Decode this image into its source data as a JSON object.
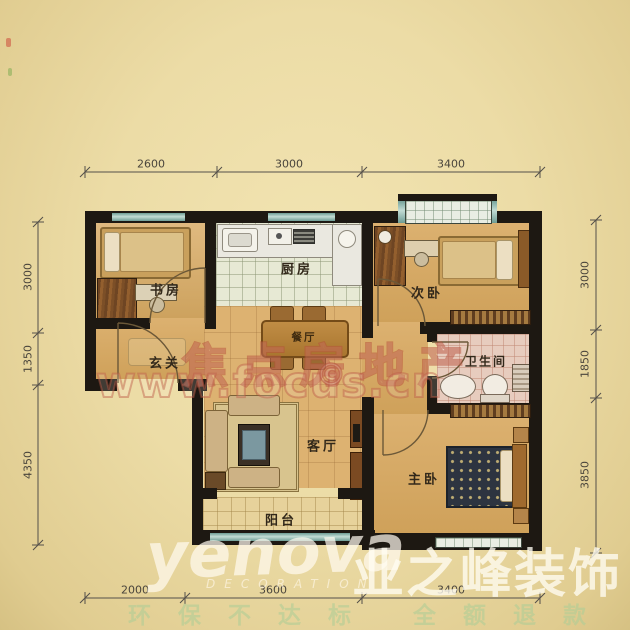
{
  "plan": {
    "rooms": [
      {
        "id": "study",
        "label": "书房"
      },
      {
        "id": "kitchen",
        "label": "厨房"
      },
      {
        "id": "bedroom2",
        "label": "次卧"
      },
      {
        "id": "entry",
        "label": "玄关"
      },
      {
        "id": "dining",
        "label": "餐厅"
      },
      {
        "id": "bathroom",
        "label": "卫生间"
      },
      {
        "id": "living",
        "label": "客厅"
      },
      {
        "id": "master",
        "label": "主卧"
      },
      {
        "id": "balcony",
        "label": "阳台"
      }
    ],
    "dimensions": {
      "top": [
        "2600",
        "3000",
        "3400"
      ],
      "bottom": [
        "2000",
        "3600",
        "3400"
      ],
      "left": [
        "3000",
        "1350",
        "4350"
      ],
      "right": [
        "3000",
        "1850",
        "3850"
      ]
    }
  },
  "watermarks": {
    "focus_title": "焦点房地产",
    "focus_url": "www.focus.cn",
    "copyright_symbol": "©",
    "brand_script": "yenova",
    "brand_sub": "DECORATION",
    "brand_cn": "业之峰装饰",
    "slogan": "环保不达标 全额退款"
  },
  "colors": {
    "paper_bg": "#ecdca6",
    "wall": "#1d1812",
    "window_teal": "#6d9c94",
    "wood_floor": "#ddb271",
    "watermark_red": "#b64e3a",
    "watermark_white": "#fffaee",
    "slogan_green": "#afcd96"
  }
}
